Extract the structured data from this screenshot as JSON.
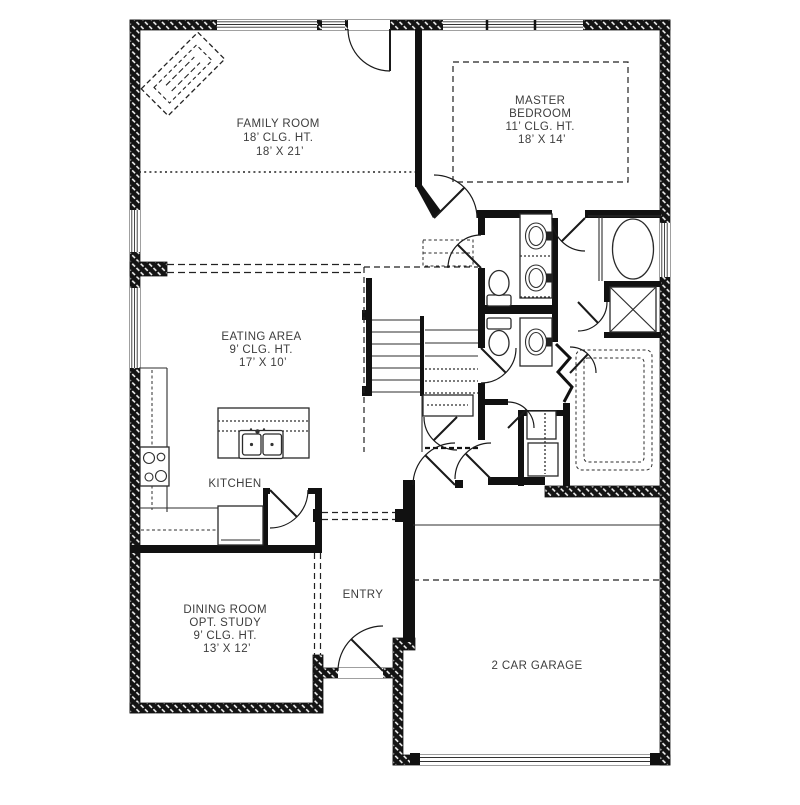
{
  "plan": {
    "type": "residential-first-floor-plan",
    "rooms": {
      "family_room": {
        "name": "FAMILY ROOM",
        "ceiling": "18’ CLG. HT.",
        "size": "18’ X 21’"
      },
      "master_bedroom": {
        "name1": "MASTER",
        "name2": "BEDROOM",
        "ceiling": "11’ CLG. HT.",
        "size": "18’ X 14’"
      },
      "eating_area": {
        "name": "EATING AREA",
        "ceiling": "9’ CLG. HT.",
        "size": "17’ X 10’"
      },
      "kitchen": {
        "name": "KITCHEN"
      },
      "dining_room": {
        "name": "DINING ROOM",
        "alt": "OPT. STUDY",
        "ceiling": "9’ CLG. HT.",
        "size": "13’ X 12’"
      },
      "entry": {
        "name": "ENTRY"
      },
      "garage": {
        "name": "2 CAR GARAGE"
      }
    },
    "colors": {
      "wall": "#111111",
      "line": "#2e2e2e",
      "text": "#3d3d3d",
      "background": "#ffffff"
    }
  }
}
